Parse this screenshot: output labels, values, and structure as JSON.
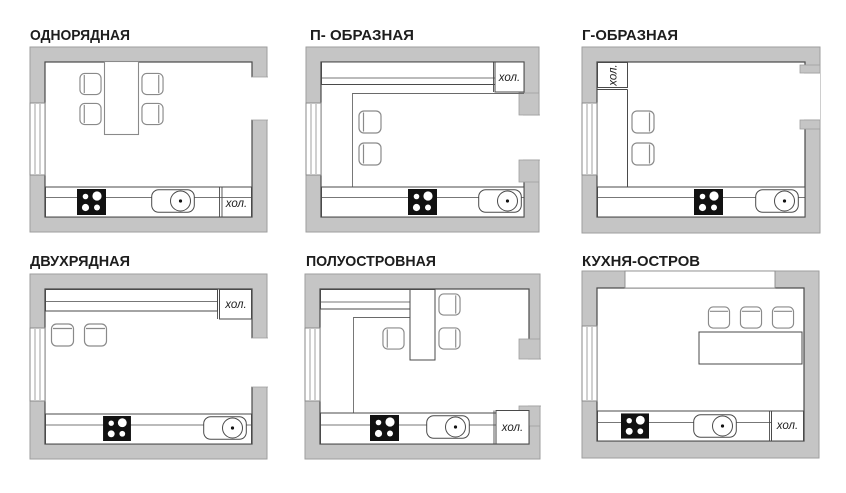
{
  "page": {
    "background": "#ffffff"
  },
  "colors": {
    "wall_fill": "#c5c5c5",
    "wall_edge": "#9e9e9e",
    "room_outline": "#4a4a4a",
    "furniture_outline": "#8a8a8a",
    "stove_fill": "#111111",
    "title_text": "#1d1d1d"
  },
  "panels": [
    {
      "title": "ОДНОРЯДНАЯ",
      "fridge_label": "хол.",
      "chair_count": 4,
      "fixtures": [
        "dining-table",
        "stove",
        "sink",
        "refrigerator",
        "window",
        "door-opening"
      ]
    },
    {
      "title": "П- ОБРАЗНАЯ",
      "fridge_label": "хол.",
      "chair_count": 2,
      "fixtures": [
        "u-shaped-counter",
        "stove",
        "sink",
        "refrigerator",
        "window",
        "door-opening"
      ]
    },
    {
      "title": "Г-ОБРАЗНАЯ",
      "fridge_label": "хол.",
      "chair_count": 2,
      "fixtures": [
        "l-shaped-counter",
        "stove",
        "sink",
        "refrigerator",
        "window",
        "door-opening"
      ]
    },
    {
      "title": "ДВУХРЯДНАЯ",
      "fridge_label": "хол.",
      "chair_count": 2,
      "fixtures": [
        "two-row-counters",
        "stove",
        "sink",
        "refrigerator",
        "window",
        "door-opening"
      ]
    },
    {
      "title": "ПОЛУОСТРОВНАЯ",
      "fridge_label": "хол.",
      "chair_count": 3,
      "fixtures": [
        "peninsula-counter",
        "stove",
        "sink",
        "refrigerator",
        "window",
        "door-opening"
      ]
    },
    {
      "title": "КУХНЯ-ОСТРОВ",
      "fridge_label": "хол.",
      "chair_count": 3,
      "fixtures": [
        "island-counter",
        "stove",
        "sink",
        "refrigerator",
        "window",
        "wall-opening"
      ]
    }
  ]
}
